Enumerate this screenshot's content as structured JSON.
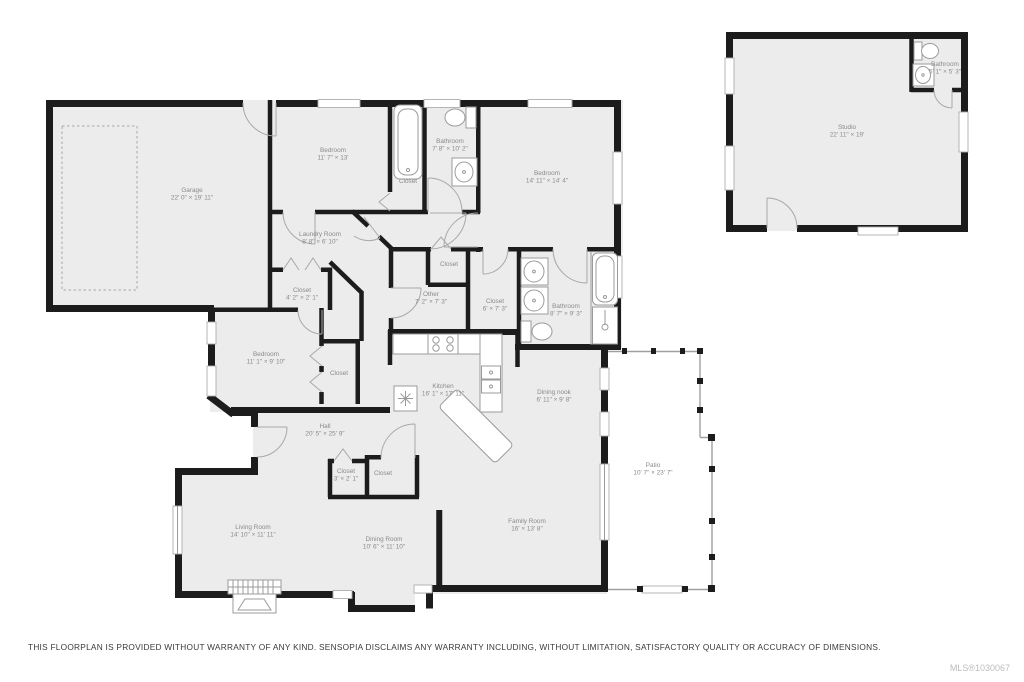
{
  "colors": {
    "wall": "#1c1c1c",
    "floor": "#ececec",
    "fixture_stroke": "#9b9b9b",
    "label_text": "#8a8a8a",
    "disclaimer_text": "#3a3a3a",
    "mls_text": "#bdbdbd"
  },
  "rooms": [
    {
      "id": "garage",
      "name": "Garage",
      "dims": "22' 0\" × 19' 11\"",
      "x": 192,
      "y": 192
    },
    {
      "id": "bedroom-1",
      "name": "Bedroom",
      "dims": "11' 7\" × 13'",
      "x": 333,
      "y": 152
    },
    {
      "id": "bathroom-1",
      "name": "Bathroom",
      "dims": "7' 8\" × 10' 2\"",
      "x": 450,
      "y": 143
    },
    {
      "id": "closet-1",
      "name": "Closet",
      "dims": "",
      "x": 408,
      "y": 183
    },
    {
      "id": "bedroom-2",
      "name": "Bedroom",
      "dims": "14' 11\" × 14' 4\"",
      "x": 547,
      "y": 175
    },
    {
      "id": "laundry-room",
      "name": "Laundry Room",
      "dims": "8' 8\" × 6' 10\"",
      "x": 320,
      "y": 236
    },
    {
      "id": "closet-2",
      "name": "Closet",
      "dims": "4' 2\" × 2' 1\"",
      "x": 302,
      "y": 292
    },
    {
      "id": "closet-3",
      "name": "Closet",
      "dims": "",
      "x": 449,
      "y": 266
    },
    {
      "id": "other",
      "name": "Other",
      "dims": "7' 2\" × 7' 3\"",
      "x": 431,
      "y": 296
    },
    {
      "id": "closet-4",
      "name": "Closet",
      "dims": "6' × 7' 3\"",
      "x": 495,
      "y": 303
    },
    {
      "id": "bathroom-2",
      "name": "Bathroom",
      "dims": "8' 7\" × 9' 3\"",
      "x": 566,
      "y": 308
    },
    {
      "id": "bedroom-3",
      "name": "Bedroom",
      "dims": "11' 1\" × 9' 10\"",
      "x": 266,
      "y": 356
    },
    {
      "id": "closet-bedroom-3",
      "name": "Closet",
      "dims": "",
      "x": 339,
      "y": 375
    },
    {
      "id": "kitchen",
      "name": "Kitchen",
      "dims": "16' 1\" × 17' 11\"",
      "x": 443,
      "y": 388
    },
    {
      "id": "dining-nook",
      "name": "Dining nook",
      "dims": "6' 11\" × 9' 8\"",
      "x": 554,
      "y": 394
    },
    {
      "id": "hall",
      "name": "Hall",
      "dims": "20' 5\" × 25' 9\"",
      "x": 325,
      "y": 428
    },
    {
      "id": "patio",
      "name": "Patio",
      "dims": "10' 7\" × 23' 7\"",
      "x": 653,
      "y": 467
    },
    {
      "id": "closet-5",
      "name": "Closet",
      "dims": "3' × 2' 1\"",
      "x": 346,
      "y": 473
    },
    {
      "id": "closet-6",
      "name": "Closet",
      "dims": "",
      "x": 383,
      "y": 475
    },
    {
      "id": "family-room",
      "name": "Family Room",
      "dims": "16' × 13' 8\"",
      "x": 527,
      "y": 523
    },
    {
      "id": "living-room",
      "name": "Living Room",
      "dims": "14' 10\" × 11' 11\"",
      "x": 253,
      "y": 529
    },
    {
      "id": "dining-room",
      "name": "Dining Room",
      "dims": "10' 6\" × 11' 10\"",
      "x": 384,
      "y": 541
    },
    {
      "id": "studio",
      "name": "Studio",
      "dims": "22' 11\" × 19'",
      "x": 847,
      "y": 129
    },
    {
      "id": "bathroom-studio",
      "name": "Bathroom",
      "dims": "5' 1\" × 5' 3\"",
      "x": 945,
      "y": 66
    }
  ],
  "fixture_icons": [
    "bathtub-icon",
    "toilet-icon",
    "sink-icon",
    "double-sink-icon",
    "stove-icon",
    "refrigerator-icon",
    "kitchen-island",
    "shower-icon",
    "fireplace-icon"
  ],
  "footer": {
    "disclaimer": "THIS FLOORPLAN IS PROVIDED WITHOUT WARRANTY OF ANY KIND. SENSOPIA DISCLAIMS ANY WARRANTY INCLUDING, WITHOUT LIMITATION, SATISFACTORY QUALITY OR ACCURACY OF DIMENSIONS.",
    "mls": "MLS®1030067"
  }
}
